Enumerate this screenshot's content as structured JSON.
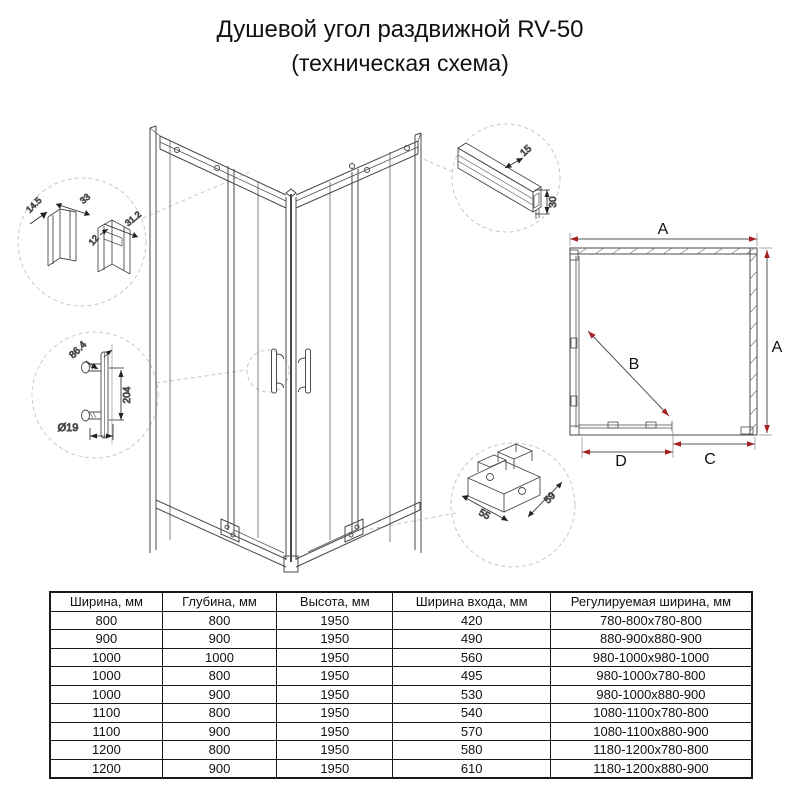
{
  "title": {
    "line1": "Душевой угол раздвижной RV-50",
    "line2": "(техническая схема)"
  },
  "colors": {
    "dimension_red": "#a62121",
    "drawing_line": "#4a4a4a",
    "dashed_grey": "#c9c9c9"
  },
  "diagram": {
    "plan": {
      "dim_top": "A",
      "dim_right": "A",
      "dim_diagonal": "B",
      "dim_bottom_left": "D",
      "dim_bottom_right": "C"
    },
    "wall_profile_detail": {
      "dim1": "14.5",
      "dim2": "33",
      "dim3": "12",
      "dim4": "31.2"
    },
    "handle_detail": {
      "dim1": "86.4",
      "dim2": "204",
      "dim3": "Ø19"
    },
    "top_rail_detail": {
      "dim1": "15",
      "dim2": "30"
    },
    "roller_detail": {
      "dim1": "55",
      "dim2": "59"
    }
  },
  "table": {
    "headers": [
      "Ширина, мм",
      "Глубина, мм",
      "Высота, мм",
      "Ширина входа, мм",
      "Регулируемая ширина, мм"
    ],
    "rows": [
      [
        "800",
        "800",
        "1950",
        "420",
        "780-800x780-800"
      ],
      [
        "900",
        "900",
        "1950",
        "490",
        "880-900x880-900"
      ],
      [
        "1000",
        "1000",
        "1950",
        "560",
        "980-1000x980-1000"
      ],
      [
        "1000",
        "800",
        "1950",
        "495",
        "980-1000x780-800"
      ],
      [
        "1000",
        "900",
        "1950",
        "530",
        "980-1000x880-900"
      ],
      [
        "1100",
        "800",
        "1950",
        "540",
        "1080-1100x780-800"
      ],
      [
        "1100",
        "900",
        "1950",
        "570",
        "1080-1100x880-900"
      ],
      [
        "1200",
        "800",
        "1950",
        "580",
        "1180-1200x780-800"
      ],
      [
        "1200",
        "900",
        "1950",
        "610",
        "1180-1200x880-900"
      ]
    ]
  }
}
